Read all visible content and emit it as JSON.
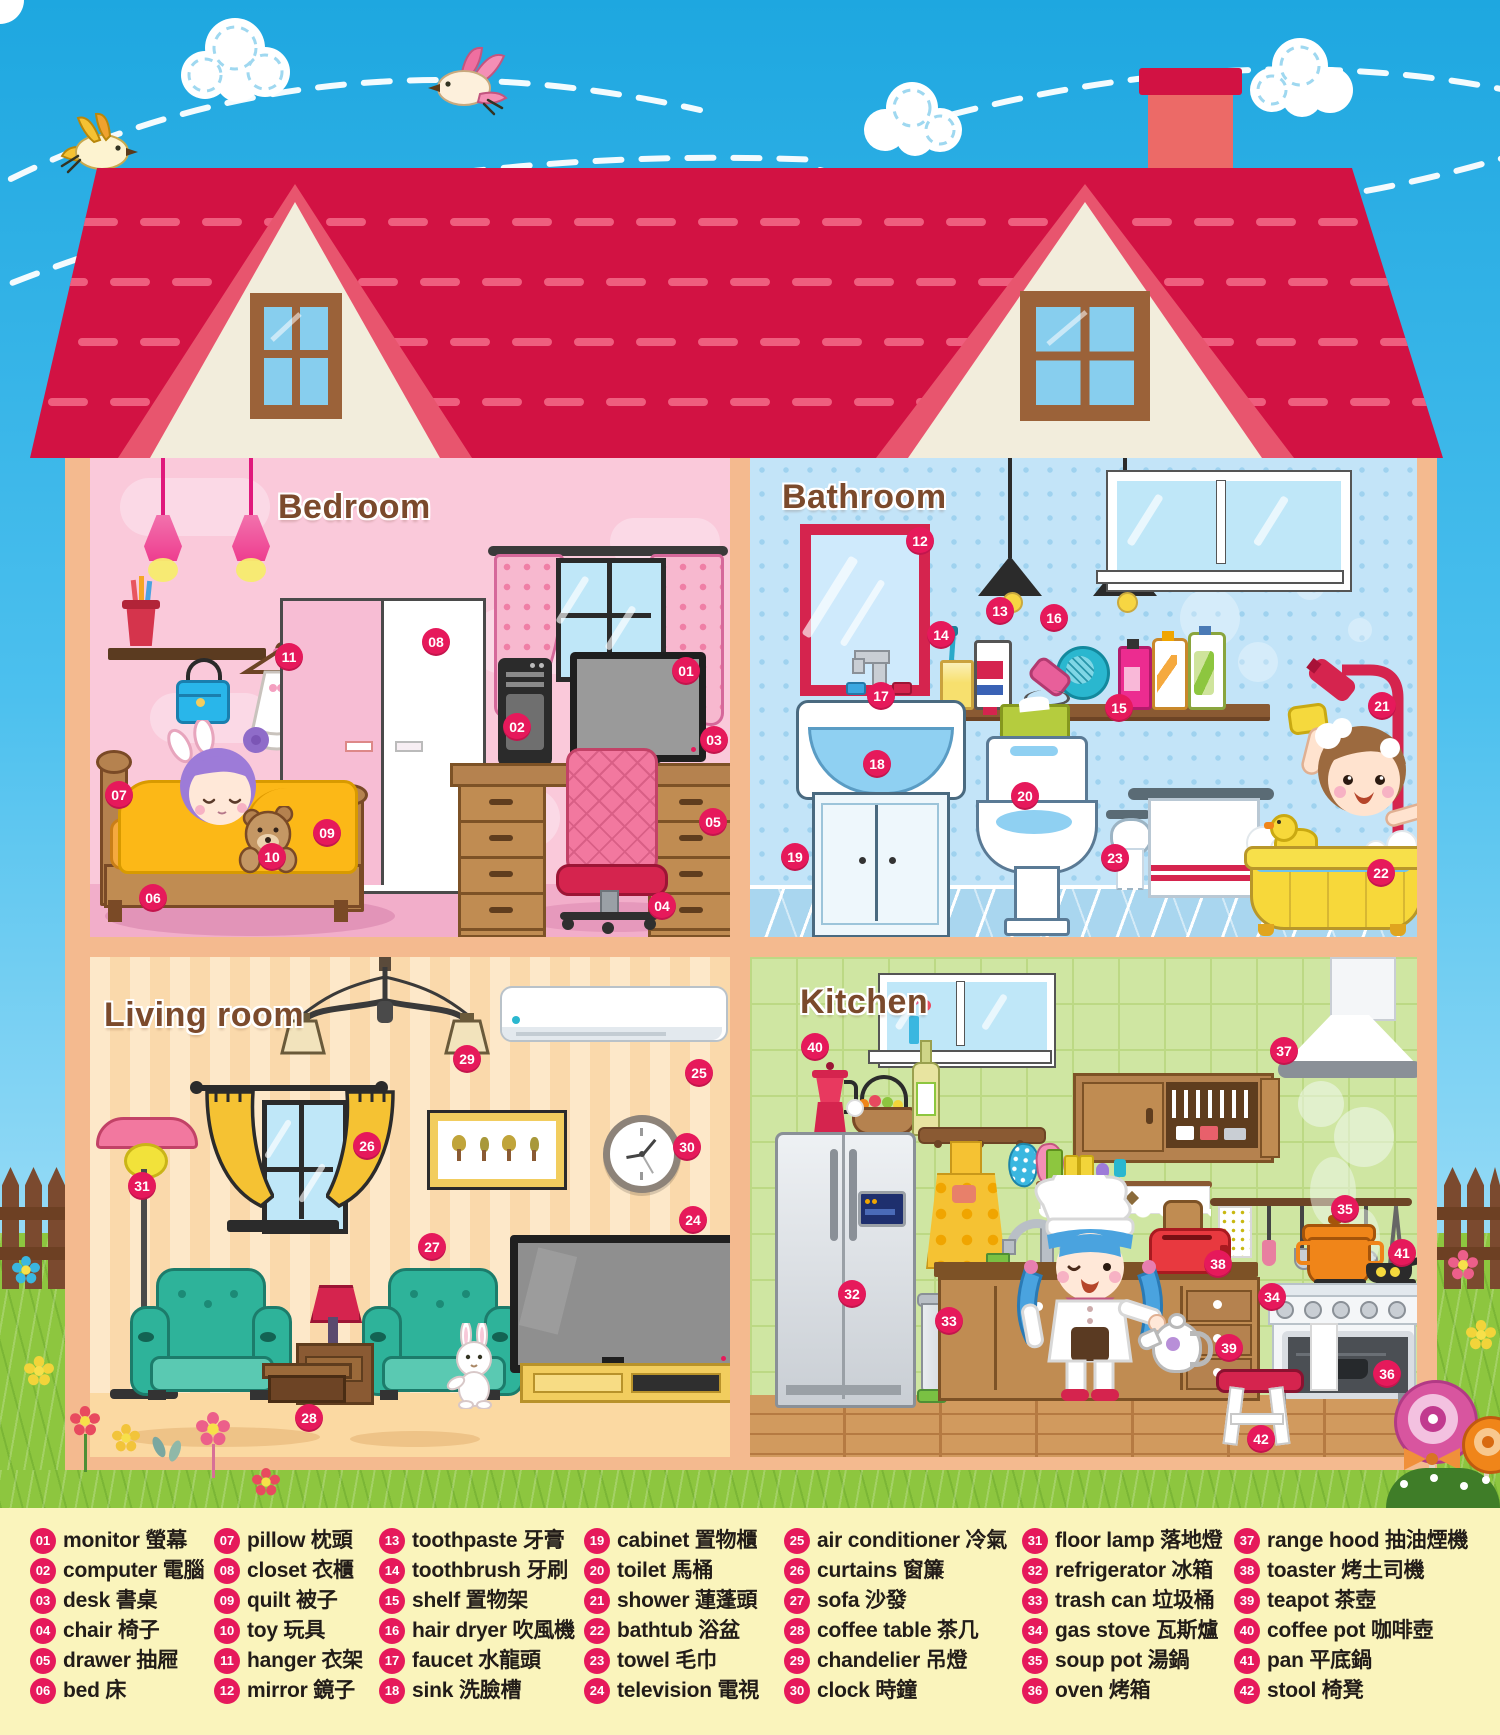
{
  "poster": {
    "type": "house rooms vocabulary diagram",
    "rooms": {
      "bedroom": "Bedroom",
      "bathroom": "Bathroom",
      "living": "Living room",
      "kitchen": "Kitchen"
    }
  },
  "legend": [
    {
      "num": "01",
      "en": "monitor",
      "zh": "螢幕"
    },
    {
      "num": "02",
      "en": "computer",
      "zh": "電腦"
    },
    {
      "num": "03",
      "en": "desk",
      "zh": "書桌"
    },
    {
      "num": "04",
      "en": "chair",
      "zh": "椅子"
    },
    {
      "num": "05",
      "en": "drawer",
      "zh": "抽屜"
    },
    {
      "num": "06",
      "en": "bed",
      "zh": "床"
    },
    {
      "num": "07",
      "en": "pillow",
      "zh": "枕頭"
    },
    {
      "num": "08",
      "en": "closet",
      "zh": "衣櫃"
    },
    {
      "num": "09",
      "en": "quilt",
      "zh": "被子"
    },
    {
      "num": "10",
      "en": "toy",
      "zh": "玩具"
    },
    {
      "num": "11",
      "en": "hanger",
      "zh": "衣架"
    },
    {
      "num": "12",
      "en": "mirror",
      "zh": "鏡子"
    },
    {
      "num": "13",
      "en": "toothpaste",
      "zh": "牙膏"
    },
    {
      "num": "14",
      "en": "toothbrush",
      "zh": "牙刷"
    },
    {
      "num": "15",
      "en": "shelf",
      "zh": "置物架"
    },
    {
      "num": "16",
      "en": "hair dryer",
      "zh": "吹風機"
    },
    {
      "num": "17",
      "en": "faucet",
      "zh": "水龍頭"
    },
    {
      "num": "18",
      "en": "sink",
      "zh": "洗臉槽"
    },
    {
      "num": "19",
      "en": "cabinet",
      "zh": "置物櫃"
    },
    {
      "num": "20",
      "en": "toilet",
      "zh": "馬桶"
    },
    {
      "num": "21",
      "en": "shower",
      "zh": "蓮蓬頭"
    },
    {
      "num": "22",
      "en": "bathtub",
      "zh": "浴盆"
    },
    {
      "num": "23",
      "en": "towel",
      "zh": "毛巾"
    },
    {
      "num": "24",
      "en": "television",
      "zh": "電視"
    },
    {
      "num": "25",
      "en": "air conditioner",
      "zh": "冷氣"
    },
    {
      "num": "26",
      "en": "curtains",
      "zh": "窗簾"
    },
    {
      "num": "27",
      "en": "sofa",
      "zh": "沙發"
    },
    {
      "num": "28",
      "en": "coffee table",
      "zh": "茶几"
    },
    {
      "num": "29",
      "en": "chandelier",
      "zh": "吊燈"
    },
    {
      "num": "30",
      "en": "clock",
      "zh": "時鐘"
    },
    {
      "num": "31",
      "en": "floor lamp",
      "zh": "落地燈"
    },
    {
      "num": "32",
      "en": "refrigerator",
      "zh": "冰箱"
    },
    {
      "num": "33",
      "en": "trash can",
      "zh": "垃圾桶"
    },
    {
      "num": "34",
      "en": "gas stove",
      "zh": "瓦斯爐"
    },
    {
      "num": "35",
      "en": "soup pot",
      "zh": "湯鍋"
    },
    {
      "num": "36",
      "en": "oven",
      "zh": "烤箱"
    },
    {
      "num": "37",
      "en": "range hood",
      "zh": "抽油煙機"
    },
    {
      "num": "38",
      "en": "toaster",
      "zh": "烤土司機"
    },
    {
      "num": "39",
      "en": "teapot",
      "zh": "茶壺"
    },
    {
      "num": "40",
      "en": "coffee pot",
      "zh": "咖啡壺"
    },
    {
      "num": "41",
      "en": "pan",
      "zh": "平底鍋"
    },
    {
      "num": "42",
      "en": "stool",
      "zh": "椅凳"
    }
  ],
  "markers": [
    {
      "n": "01",
      "x": 686,
      "y": 671
    },
    {
      "n": "02",
      "x": 517,
      "y": 727
    },
    {
      "n": "03",
      "x": 714,
      "y": 740
    },
    {
      "n": "04",
      "x": 662,
      "y": 906
    },
    {
      "n": "05",
      "x": 713,
      "y": 822
    },
    {
      "n": "06",
      "x": 153,
      "y": 898
    },
    {
      "n": "07",
      "x": 119,
      "y": 795
    },
    {
      "n": "08",
      "x": 436,
      "y": 642
    },
    {
      "n": "09",
      "x": 327,
      "y": 833
    },
    {
      "n": "10",
      "x": 272,
      "y": 857
    },
    {
      "n": "11",
      "x": 289,
      "y": 657
    },
    {
      "n": "12",
      "x": 920,
      "y": 541
    },
    {
      "n": "13",
      "x": 1000,
      "y": 611
    },
    {
      "n": "14",
      "x": 941,
      "y": 635
    },
    {
      "n": "15",
      "x": 1119,
      "y": 708
    },
    {
      "n": "16",
      "x": 1054,
      "y": 618
    },
    {
      "n": "17",
      "x": 881,
      "y": 696
    },
    {
      "n": "18",
      "x": 877,
      "y": 764
    },
    {
      "n": "19",
      "x": 795,
      "y": 857
    },
    {
      "n": "20",
      "x": 1025,
      "y": 796
    },
    {
      "n": "21",
      "x": 1382,
      "y": 706
    },
    {
      "n": "22",
      "x": 1381,
      "y": 873
    },
    {
      "n": "23",
      "x": 1115,
      "y": 858
    },
    {
      "n": "24",
      "x": 693,
      "y": 1220
    },
    {
      "n": "25",
      "x": 699,
      "y": 1073
    },
    {
      "n": "26",
      "x": 367,
      "y": 1146
    },
    {
      "n": "27",
      "x": 432,
      "y": 1247
    },
    {
      "n": "28",
      "x": 309,
      "y": 1418
    },
    {
      "n": "29",
      "x": 467,
      "y": 1059
    },
    {
      "n": "30",
      "x": 687,
      "y": 1147
    },
    {
      "n": "31",
      "x": 142,
      "y": 1186
    },
    {
      "n": "32",
      "x": 852,
      "y": 1294
    },
    {
      "n": "33",
      "x": 949,
      "y": 1321
    },
    {
      "n": "34",
      "x": 1272,
      "y": 1297
    },
    {
      "n": "35",
      "x": 1345,
      "y": 1209
    },
    {
      "n": "36",
      "x": 1387,
      "y": 1374
    },
    {
      "n": "37",
      "x": 1284,
      "y": 1051
    },
    {
      "n": "38",
      "x": 1218,
      "y": 1264
    },
    {
      "n": "39",
      "x": 1229,
      "y": 1348
    },
    {
      "n": "40",
      "x": 815,
      "y": 1047
    },
    {
      "n": "41",
      "x": 1402,
      "y": 1253
    },
    {
      "n": "42",
      "x": 1261,
      "y": 1439
    }
  ],
  "colors": {
    "marker": "#e6195b",
    "roof": "#d21243",
    "roof_dash": "#ef5e7e",
    "chimney": "#ec6a67",
    "house_frame": "#f4ba8f",
    "bedroom_wall": "#fac9da",
    "bathroom_wall": "#c3e4f8",
    "living_wall": "#fde8c9",
    "kitchen_wall": "#cfe6a2",
    "grass": "#8dc63f",
    "legend_bg": "#faf4bc",
    "title_text": "#7b4a2c",
    "sky": "#1ea7e0"
  }
}
